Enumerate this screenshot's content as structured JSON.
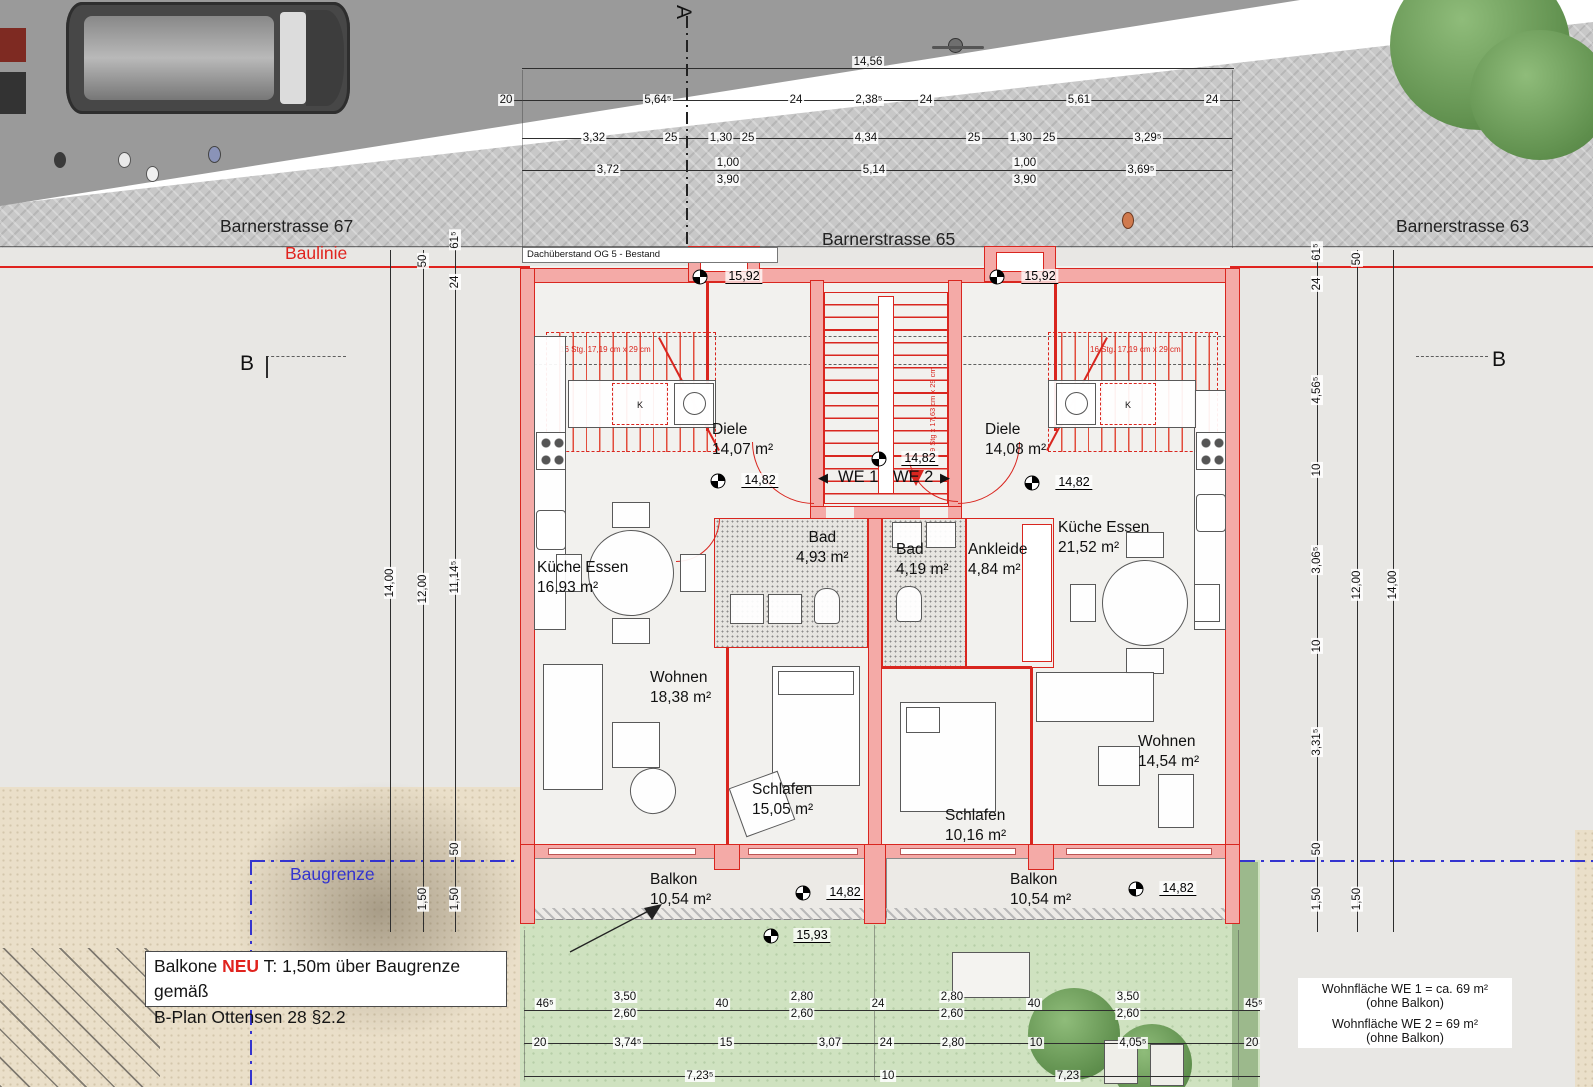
{
  "streets": {
    "left": "Barnerstrasse 67",
    "center": "Barnerstrasse 65",
    "right": "Barnerstrasse 63"
  },
  "lines": {
    "baulinie": "Baulinie",
    "baugrenze": "Baugrenze"
  },
  "roof_note": "Dachüberstand OG 5 - Bestand",
  "section": {
    "a": "A",
    "b_left": "B",
    "b_right": "B"
  },
  "entry": {
    "left_arrow": "◀",
    "we1": "WE 1",
    "we2": "WE 2",
    "right_arrow": "▶"
  },
  "rooms": {
    "we1_diele": {
      "name": "Diele",
      "area": "14,07 m²"
    },
    "we1_kueche": {
      "name": "Küche Essen",
      "area": "16,93 m²"
    },
    "we1_bad": {
      "name": "Bad",
      "area": "4,93 m²"
    },
    "we1_wohnen": {
      "name": "Wohnen",
      "area": "18,38 m²"
    },
    "we1_schlafen": {
      "name": "Schlafen",
      "area": "15,05 m²"
    },
    "we1_balkon": {
      "name": "Balkon",
      "area": "10,54 m²"
    },
    "we2_diele": {
      "name": "Diele",
      "area": "14,08 m²"
    },
    "we2_bad": {
      "name": "Bad",
      "area": "4,19 m²"
    },
    "we2_ankleide": {
      "name": "Ankleide",
      "area": "4,84 m²"
    },
    "we2_kueche": {
      "name": "Küche Essen",
      "area": "21,52 m²"
    },
    "we2_wohnen": {
      "name": "Wohnen",
      "area": "14,54 m²"
    },
    "we2_schlafen": {
      "name": "Schlafen",
      "area": "10,16 m²"
    },
    "we2_balkon": {
      "name": "Balkon",
      "area": "10,54 m²"
    }
  },
  "levels": {
    "roof_left": "15,92",
    "roof_right": "15,92",
    "diele1": "14,82",
    "hall": "14,82",
    "diele2": "14,82",
    "balkon1": "14,82",
    "balkon2": "14,82",
    "terrace": "15,93"
  },
  "stairs": {
    "left": "16 Stg. 17,19 cm x 29 cm",
    "right": "16 Stg. 17,19 cm x 29 cm",
    "center": "9 Stg x 17,63 cm x 29 cm",
    "k": "K"
  },
  "note_box": {
    "part1": "Balkone ",
    "highlight": "NEU",
    "part2": " T: 1,50m über Baugrenze gemäß",
    "line2": "B-Plan Ottensen 28 §2.2"
  },
  "legend": {
    "line1": "Wohnfläche WE 1 = ca.  69 m²",
    "line1b": "(ohne Balkon)",
    "line2": "Wohnfläche WE 2 = 69 m²",
    "line2b": "(ohne Balkon)"
  },
  "dims": {
    "t1": [
      "14,56"
    ],
    "t2": [
      "20",
      "5,64⁵",
      "24",
      "2,38⁵",
      "24",
      "5,61",
      "24"
    ],
    "t3": [
      "3,32",
      "25",
      "1,30",
      "25",
      "4,34",
      "25",
      "1,30",
      "25",
      "3,29⁵"
    ],
    "t4": [
      "3,72",
      "1,00",
      "3,90",
      "5,14",
      "1,00",
      "3,90",
      "3,69⁵"
    ],
    "bA": [
      "46⁵",
      "3,50",
      "2,60",
      "40",
      "2,80",
      "2,60",
      "24",
      "2,80",
      "2,60",
      "40",
      "3,50",
      "2,60",
      "45⁵"
    ],
    "bB": [
      "20",
      "3,74⁵",
      "15",
      "3,07",
      "24",
      "2,80",
      "10",
      "4,05⁵",
      "20"
    ],
    "bC": [
      "7,23⁵",
      "10",
      "7,23"
    ],
    "L": [
      "61⁵",
      "50",
      "24",
      "14,00",
      "12,00",
      "11,14⁵",
      "50",
      "1,50",
      "1,50"
    ],
    "R": [
      "61⁵",
      "50",
      "24",
      "4,56⁵",
      "10",
      "3,06⁵",
      "10",
      "3,31⁵",
      "50",
      "12,00",
      "14,00",
      "1,50",
      "1,50"
    ]
  }
}
